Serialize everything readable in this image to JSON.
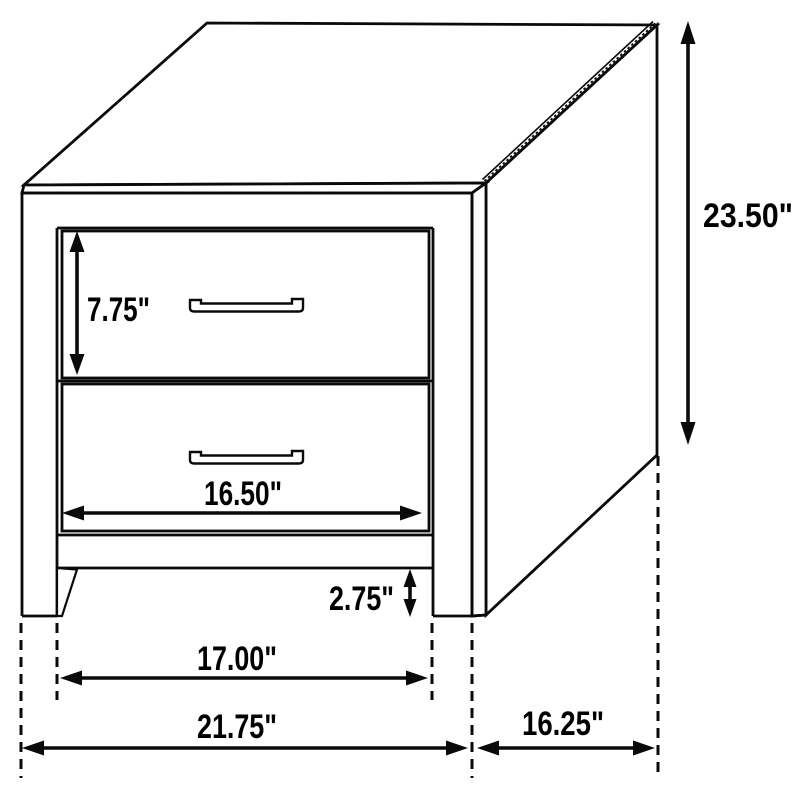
{
  "diagram": {
    "subject": "nightstand-dimension-drawing",
    "colors": {
      "line": "#0a0a0a",
      "background": "#ffffff"
    },
    "dimensions": {
      "drawer_height": "7.75\"",
      "overall_height": "23.50\"",
      "drawer_opening_width": "16.50\"",
      "leg_height": "2.75\"",
      "leg_span_width": "17.00\"",
      "overall_width": "21.75\"",
      "overall_depth": "16.25\""
    }
  }
}
